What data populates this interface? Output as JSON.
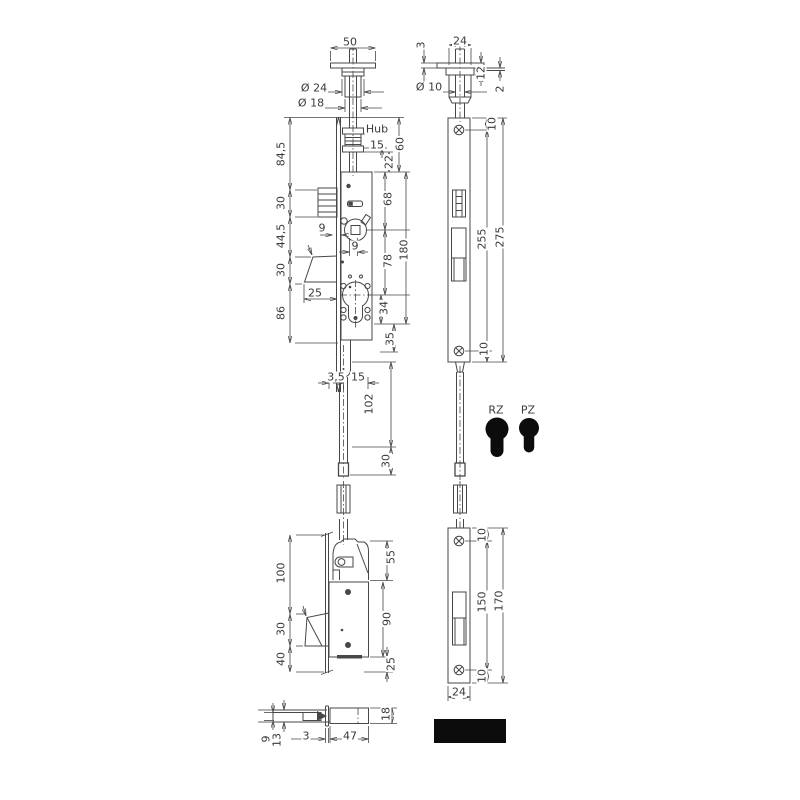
{
  "drawing": {
    "type": "technical-drawing-multibolt-lock",
    "line_color": "#474747",
    "black_fill": "#0c0c0c",
    "labels": [
      {
        "text": "50",
        "x": 350,
        "y": 42,
        "rot": false
      },
      {
        "text": "Ø 24",
        "x": 314,
        "y": 88,
        "rot": false
      },
      {
        "text": "Ø 18",
        "x": 311,
        "y": 103,
        "rot": false
      },
      {
        "text": "Hub",
        "x": 377,
        "y": 129,
        "rot": false
      },
      {
        "text": "15",
        "x": 377,
        "y": 145,
        "rot": false
      },
      {
        "text": "60",
        "x": 400,
        "y": 144,
        "rot": true
      },
      {
        "text": "22",
        "x": 389,
        "y": 162,
        "rot": true
      },
      {
        "text": "84,5",
        "x": 281,
        "y": 154,
        "rot": true
      },
      {
        "text": "30",
        "x": 281,
        "y": 203,
        "rot": true
      },
      {
        "text": "44,5",
        "x": 281,
        "y": 236,
        "rot": true
      },
      {
        "text": "30",
        "x": 281,
        "y": 270,
        "rot": true
      },
      {
        "text": "86",
        "x": 281,
        "y": 313,
        "rot": true
      },
      {
        "text": "9",
        "x": 322,
        "y": 228,
        "rot": false
      },
      {
        "text": "9",
        "x": 355,
        "y": 246,
        "rot": false
      },
      {
        "text": "25",
        "x": 315,
        "y": 293,
        "rot": false
      },
      {
        "text": "68",
        "x": 388,
        "y": 199,
        "rot": true
      },
      {
        "text": "180",
        "x": 404,
        "y": 250,
        "rot": true
      },
      {
        "text": "78",
        "x": 388,
        "y": 261,
        "rot": true
      },
      {
        "text": "34",
        "x": 384,
        "y": 308,
        "rot": true
      },
      {
        "text": "35",
        "x": 390,
        "y": 339,
        "rot": true
      },
      {
        "text": "3,5",
        "x": 336,
        "y": 377,
        "rot": false
      },
      {
        "text": "15",
        "x": 358,
        "y": 377,
        "rot": false
      },
      {
        "text": "102",
        "x": 369,
        "y": 404,
        "rot": true
      },
      {
        "text": "30",
        "x": 386,
        "y": 461,
        "rot": true
      },
      {
        "text": "3",
        "x": 421,
        "y": 45,
        "rot": true
      },
      {
        "text": "24",
        "x": 460,
        "y": 41,
        "rot": false
      },
      {
        "text": "Ø 10",
        "x": 429,
        "y": 87,
        "rot": false
      },
      {
        "text": "12",
        "x": 481,
        "y": 73,
        "rot": true
      },
      {
        "text": "2",
        "x": 500,
        "y": 89,
        "rot": true
      },
      {
        "text": "10",
        "x": 492,
        "y": 124,
        "rot": true
      },
      {
        "text": "255",
        "x": 482,
        "y": 239,
        "rot": true
      },
      {
        "text": "275",
        "x": 500,
        "y": 237,
        "rot": true
      },
      {
        "text": "10",
        "x": 484,
        "y": 349,
        "rot": true
      },
      {
        "text": "RZ",
        "x": 496,
        "y": 410,
        "rot": false,
        "name": "cylinder-option-rz-label"
      },
      {
        "text": "PZ",
        "x": 528,
        "y": 410,
        "rot": false,
        "name": "cylinder-option-pz-label"
      },
      {
        "text": "100",
        "x": 281,
        "y": 573,
        "rot": true
      },
      {
        "text": "30",
        "x": 281,
        "y": 629,
        "rot": true
      },
      {
        "text": "40",
        "x": 281,
        "y": 659,
        "rot": true
      },
      {
        "text": "55",
        "x": 391,
        "y": 557,
        "rot": true
      },
      {
        "text": "90",
        "x": 387,
        "y": 619,
        "rot": true
      },
      {
        "text": "25",
        "x": 391,
        "y": 664,
        "rot": true
      },
      {
        "text": "10",
        "x": 482,
        "y": 535,
        "rot": true
      },
      {
        "text": "150",
        "x": 482,
        "y": 602,
        "rot": true
      },
      {
        "text": "170",
        "x": 499,
        "y": 601,
        "rot": true
      },
      {
        "text": "10",
        "x": 482,
        "y": 676,
        "rot": true
      },
      {
        "text": "24",
        "x": 459,
        "y": 692,
        "rot": false
      },
      {
        "text": "9",
        "x": 266,
        "y": 739,
        "rot": true
      },
      {
        "text": "13",
        "x": 277,
        "y": 740,
        "rot": true
      },
      {
        "text": "3",
        "x": 306,
        "y": 736,
        "rot": false
      },
      {
        "text": "47",
        "x": 350,
        "y": 736,
        "rot": false
      },
      {
        "text": "18",
        "x": 386,
        "y": 714,
        "rot": true
      }
    ]
  }
}
